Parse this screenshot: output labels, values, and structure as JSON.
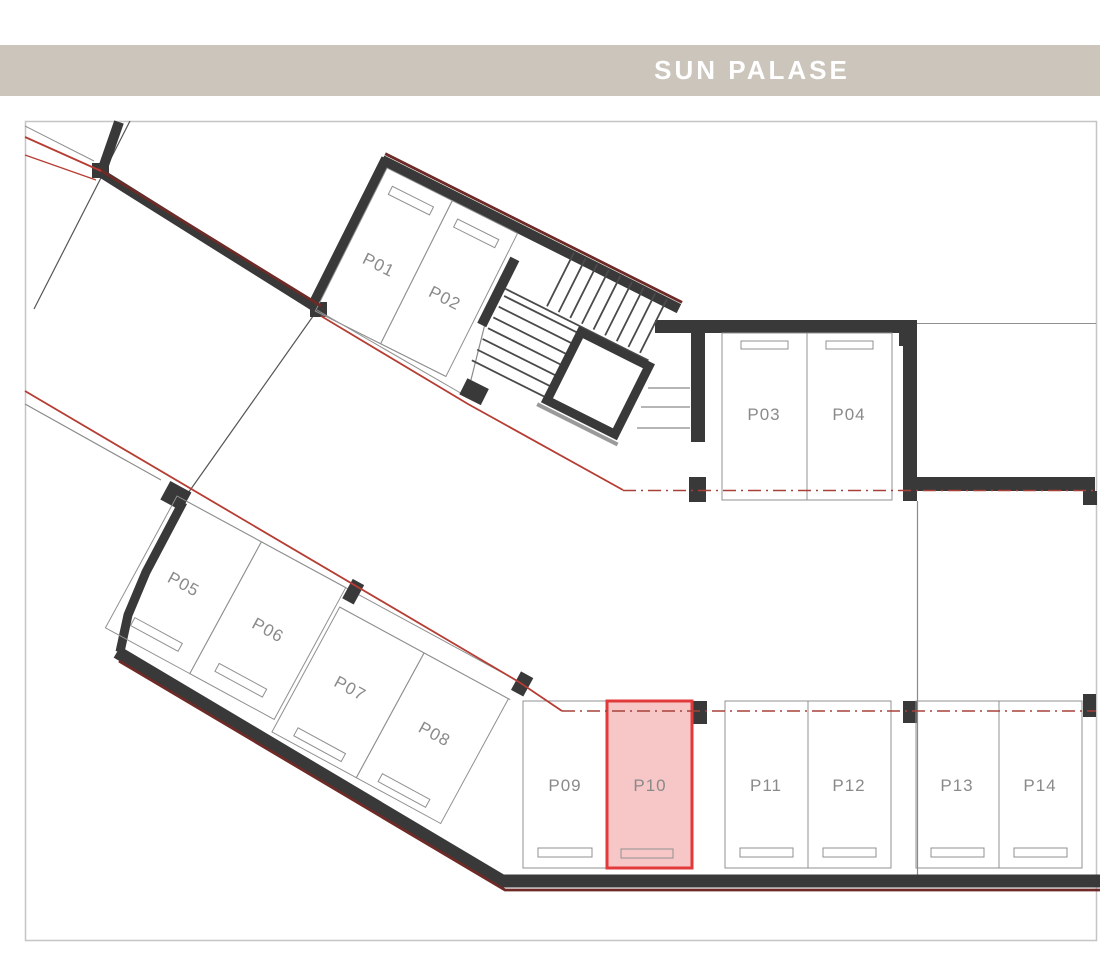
{
  "header": {
    "title": "SUN PALASE"
  },
  "colors": {
    "header_bg": "#cbc5bc",
    "header_text": "#ffffff",
    "wall": "#393939",
    "outline_gray": "#909090",
    "label_gray": "#8a8a8a",
    "accent_red": "#b63d34",
    "accent_dark_red": "#6e2a26",
    "highlight_fill": "#f7c6c7",
    "highlight_border": "#e23a3a"
  },
  "plan": {
    "highlighted_stall": "P10",
    "bands": [
      {
        "id": "upper-band",
        "transform": "translate(387,168) rotate(26.6)",
        "stalls": [
          {
            "label": "P01",
            "x": 0,
            "y": 0,
            "w": 73,
            "h": 160,
            "stop": [
              13,
              14,
              46,
              9
            ],
            "label_pos": [
              36,
              96
            ],
            "highlighted": false
          },
          {
            "label": "P02",
            "x": 73,
            "y": 0,
            "w": 73,
            "h": 160,
            "stop": [
              86,
              14,
              46,
              9
            ],
            "label_pos": [
              110,
              96
            ],
            "highlighted": false
          }
        ]
      },
      {
        "id": "middle-band",
        "transform": "translate(177,496) rotate(28.5)",
        "stalls": [
          {
            "label": "P05",
            "x": 0,
            "y": 0,
            "w": 96,
            "h": 150,
            "stop": [
              21,
              127,
              54,
              9
            ],
            "label_pos": [
              48,
              80
            ],
            "highlighted": false
          },
          {
            "label": "P06",
            "x": 96,
            "y": 0,
            "w": 96,
            "h": 150,
            "stop": [
              117,
              127,
              54,
              9
            ],
            "label_pos": [
              144,
              80
            ],
            "highlighted": false
          },
          {
            "label": "P07",
            "x": 196,
            "y": 20,
            "w": 96,
            "h": 142,
            "stop": [
              217,
              146,
              54,
              9
            ],
            "label_pos": [
              244,
              92
            ],
            "highlighted": false
          },
          {
            "label": "P08",
            "x": 292,
            "y": 20,
            "w": 96,
            "h": 142,
            "stop": [
              313,
              146,
              54,
              9
            ],
            "label_pos": [
              340,
              92
            ],
            "highlighted": false
          }
        ]
      },
      {
        "id": "upper-row",
        "transform": "",
        "stalls": [
          {
            "label": "P03",
            "x": 722,
            "y": 333,
            "w": 85,
            "h": 167,
            "stop": [
              741,
              341,
              47,
              8
            ],
            "label_pos": [
              764,
              420
            ],
            "highlighted": false
          },
          {
            "label": "P04",
            "x": 807,
            "y": 333,
            "w": 85,
            "h": 167,
            "stop": [
              826,
              341,
              47,
              8
            ],
            "label_pos": [
              849,
              420
            ],
            "highlighted": false
          }
        ]
      },
      {
        "id": "bottom-row",
        "transform": "",
        "stalls": [
          {
            "label": "P09",
            "x": 523,
            "y": 701,
            "w": 84,
            "h": 167,
            "stop": [
              538,
              848,
              54,
              9
            ],
            "label_pos": [
              565,
              791
            ],
            "highlighted": false
          },
          {
            "label": "P10",
            "x": 607,
            "y": 701,
            "w": 85,
            "h": 167,
            "stop": [
              621,
              849,
              52,
              9
            ],
            "label_pos": [
              650,
              791
            ],
            "highlighted": true
          },
          {
            "label": "P11",
            "x": 725,
            "y": 701,
            "w": 83,
            "h": 167,
            "stop": [
              740,
              848,
              53,
              9
            ],
            "label_pos": [
              766,
              791
            ],
            "highlighted": false
          },
          {
            "label": "P12",
            "x": 808,
            "y": 701,
            "w": 83,
            "h": 167,
            "stop": [
              823,
              848,
              53,
              9
            ],
            "label_pos": [
              849,
              791
            ],
            "highlighted": false
          },
          {
            "label": "P13",
            "x": 916,
            "y": 701,
            "w": 83,
            "h": 167,
            "stop": [
              931,
              848,
              53,
              9
            ],
            "label_pos": [
              957,
              791
            ],
            "highlighted": false
          },
          {
            "label": "P14",
            "x": 999,
            "y": 701,
            "w": 83,
            "h": 167,
            "stop": [
              1014,
              848,
              53,
              9
            ],
            "label_pos": [
              1040,
              791
            ],
            "highlighted": false
          }
        ]
      }
    ]
  }
}
